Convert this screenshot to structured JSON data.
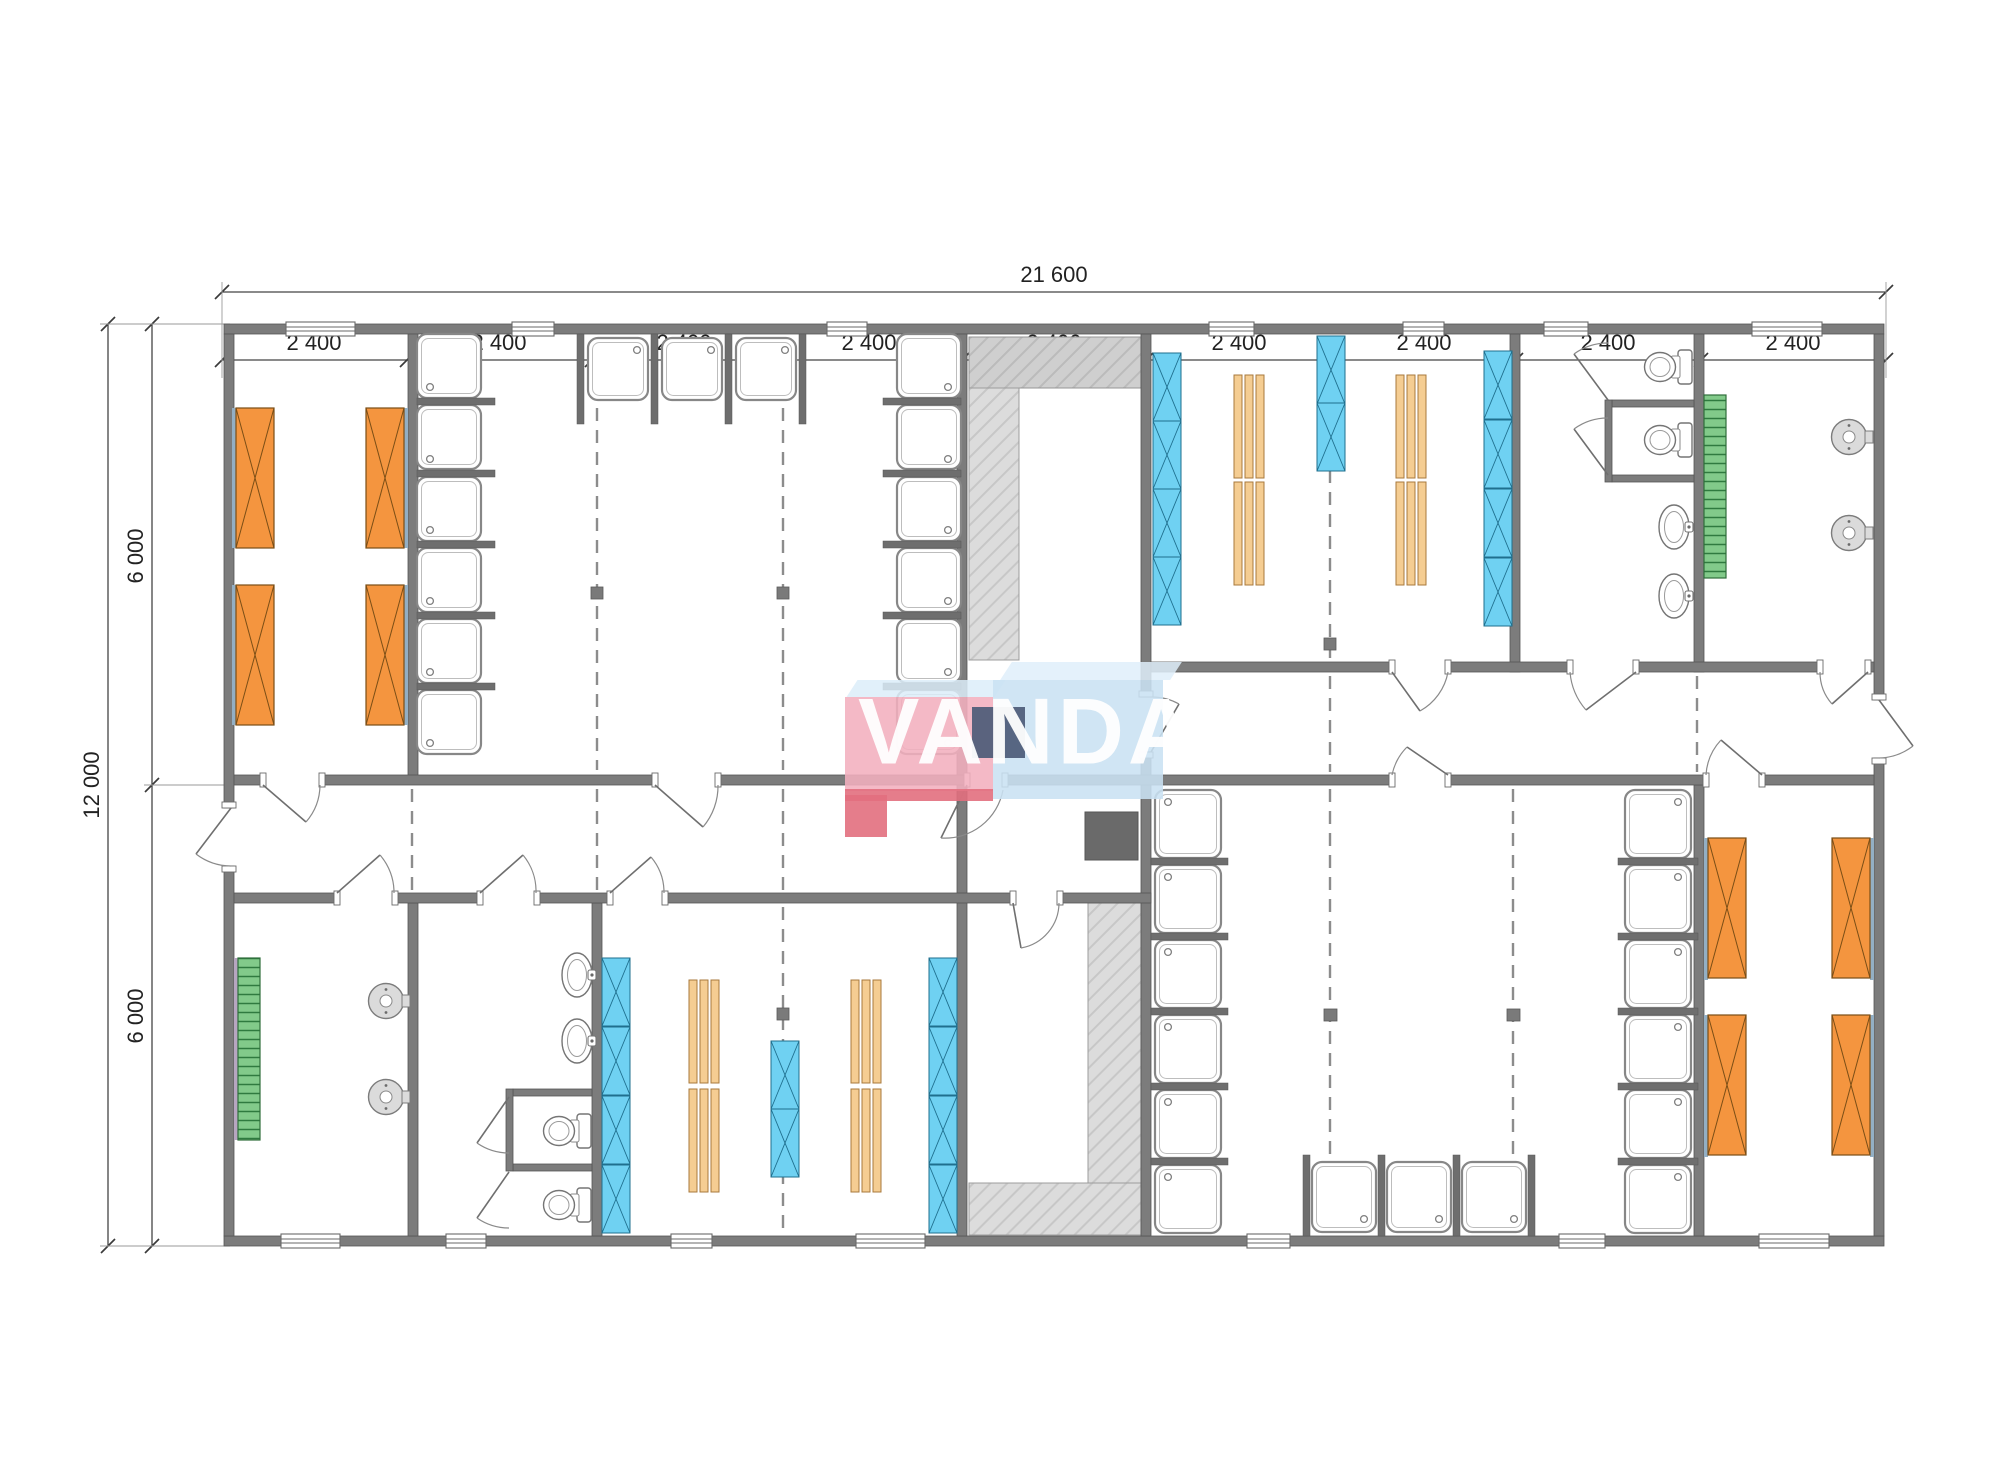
{
  "drawing": {
    "type": "floor-plan",
    "brand_watermark": "VANDA"
  },
  "dimensions": {
    "top_total": {
      "label": "21 600"
    },
    "top_bays": {
      "labels": [
        "2 400",
        "2 400",
        "2 400",
        "2 400",
        "2 400",
        "2 400",
        "2 400",
        "2 400",
        "2 400"
      ]
    },
    "left_total": {
      "label": "12 000"
    },
    "left_halves": {
      "labels": [
        "6 000",
        "6 000"
      ]
    }
  },
  "logo": {
    "part1": "VA",
    "part2": "N",
    "part3": "DA"
  },
  "fixture_types": [
    "shower-tray",
    "toilet",
    "washbasin",
    "round-washbasin",
    "bunk-bed",
    "wardrobe-unit",
    "bench",
    "green-bench",
    "structural-column",
    "service-shaft",
    "ramp-hatch",
    "window",
    "door"
  ],
  "colors": {
    "wall": "#7C7C7C",
    "bunk_orange": "#F4953F",
    "wardrobe_blue": "#6FD1F2",
    "bench_tan": "#F5CD92",
    "bench_green": "#82CA8A",
    "hatch_gray": "#DCDCDC",
    "logo_pink": "#F2AFBE",
    "logo_red": "#E26F7E",
    "logo_blue": "#C9E1F3",
    "logo_navy": "#4D5C78"
  }
}
